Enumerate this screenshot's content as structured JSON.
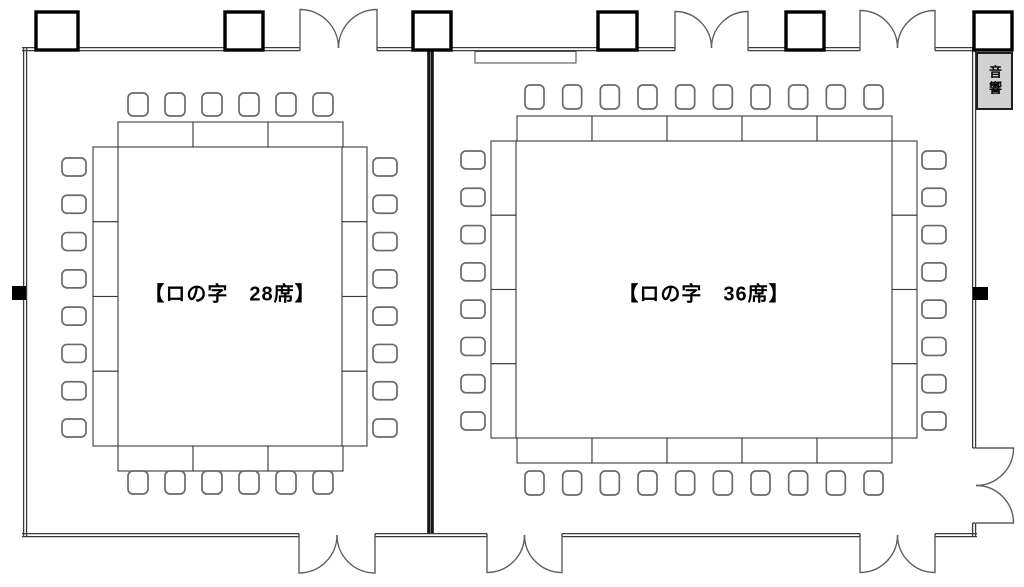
{
  "page": {
    "background": "#ffffff"
  },
  "colors": {
    "wall": "#3c3c3c",
    "partition": "#161616",
    "door": "#5f5f5f",
    "table_border": "#3b3b3b",
    "chair_border": "#6a6a6a",
    "column_border": "#000000",
    "outlet": "#000000",
    "audio_panel_fill": "#d2d2d2",
    "text": "#000000"
  },
  "rooms": [
    {
      "id": "left-room",
      "label": "【ロの字　28席】",
      "layout_type": "口の字 (hollow square)",
      "seats": 28,
      "tables": {
        "top": 3,
        "bottom": 3,
        "left": 4,
        "right": 4
      },
      "chairs": {
        "top": 6,
        "bottom": 6,
        "left": 8,
        "right": 8
      }
    },
    {
      "id": "right-room",
      "label": "【ロの字　36席】",
      "layout_type": "口の字 (hollow square)",
      "seats": 36,
      "tables": {
        "top": 5,
        "bottom": 5,
        "left": 4,
        "right": 4
      },
      "chairs": {
        "top": 10,
        "bottom": 10,
        "left": 8,
        "right": 8
      }
    }
  ],
  "equipment": {
    "audio_label": "音響"
  },
  "architecture": {
    "top_double_doors": 3,
    "bottom_double_doors": 3,
    "right_double_doors": 1,
    "columns": 6,
    "wall_outlets": 2,
    "partition_walls": 1
  }
}
